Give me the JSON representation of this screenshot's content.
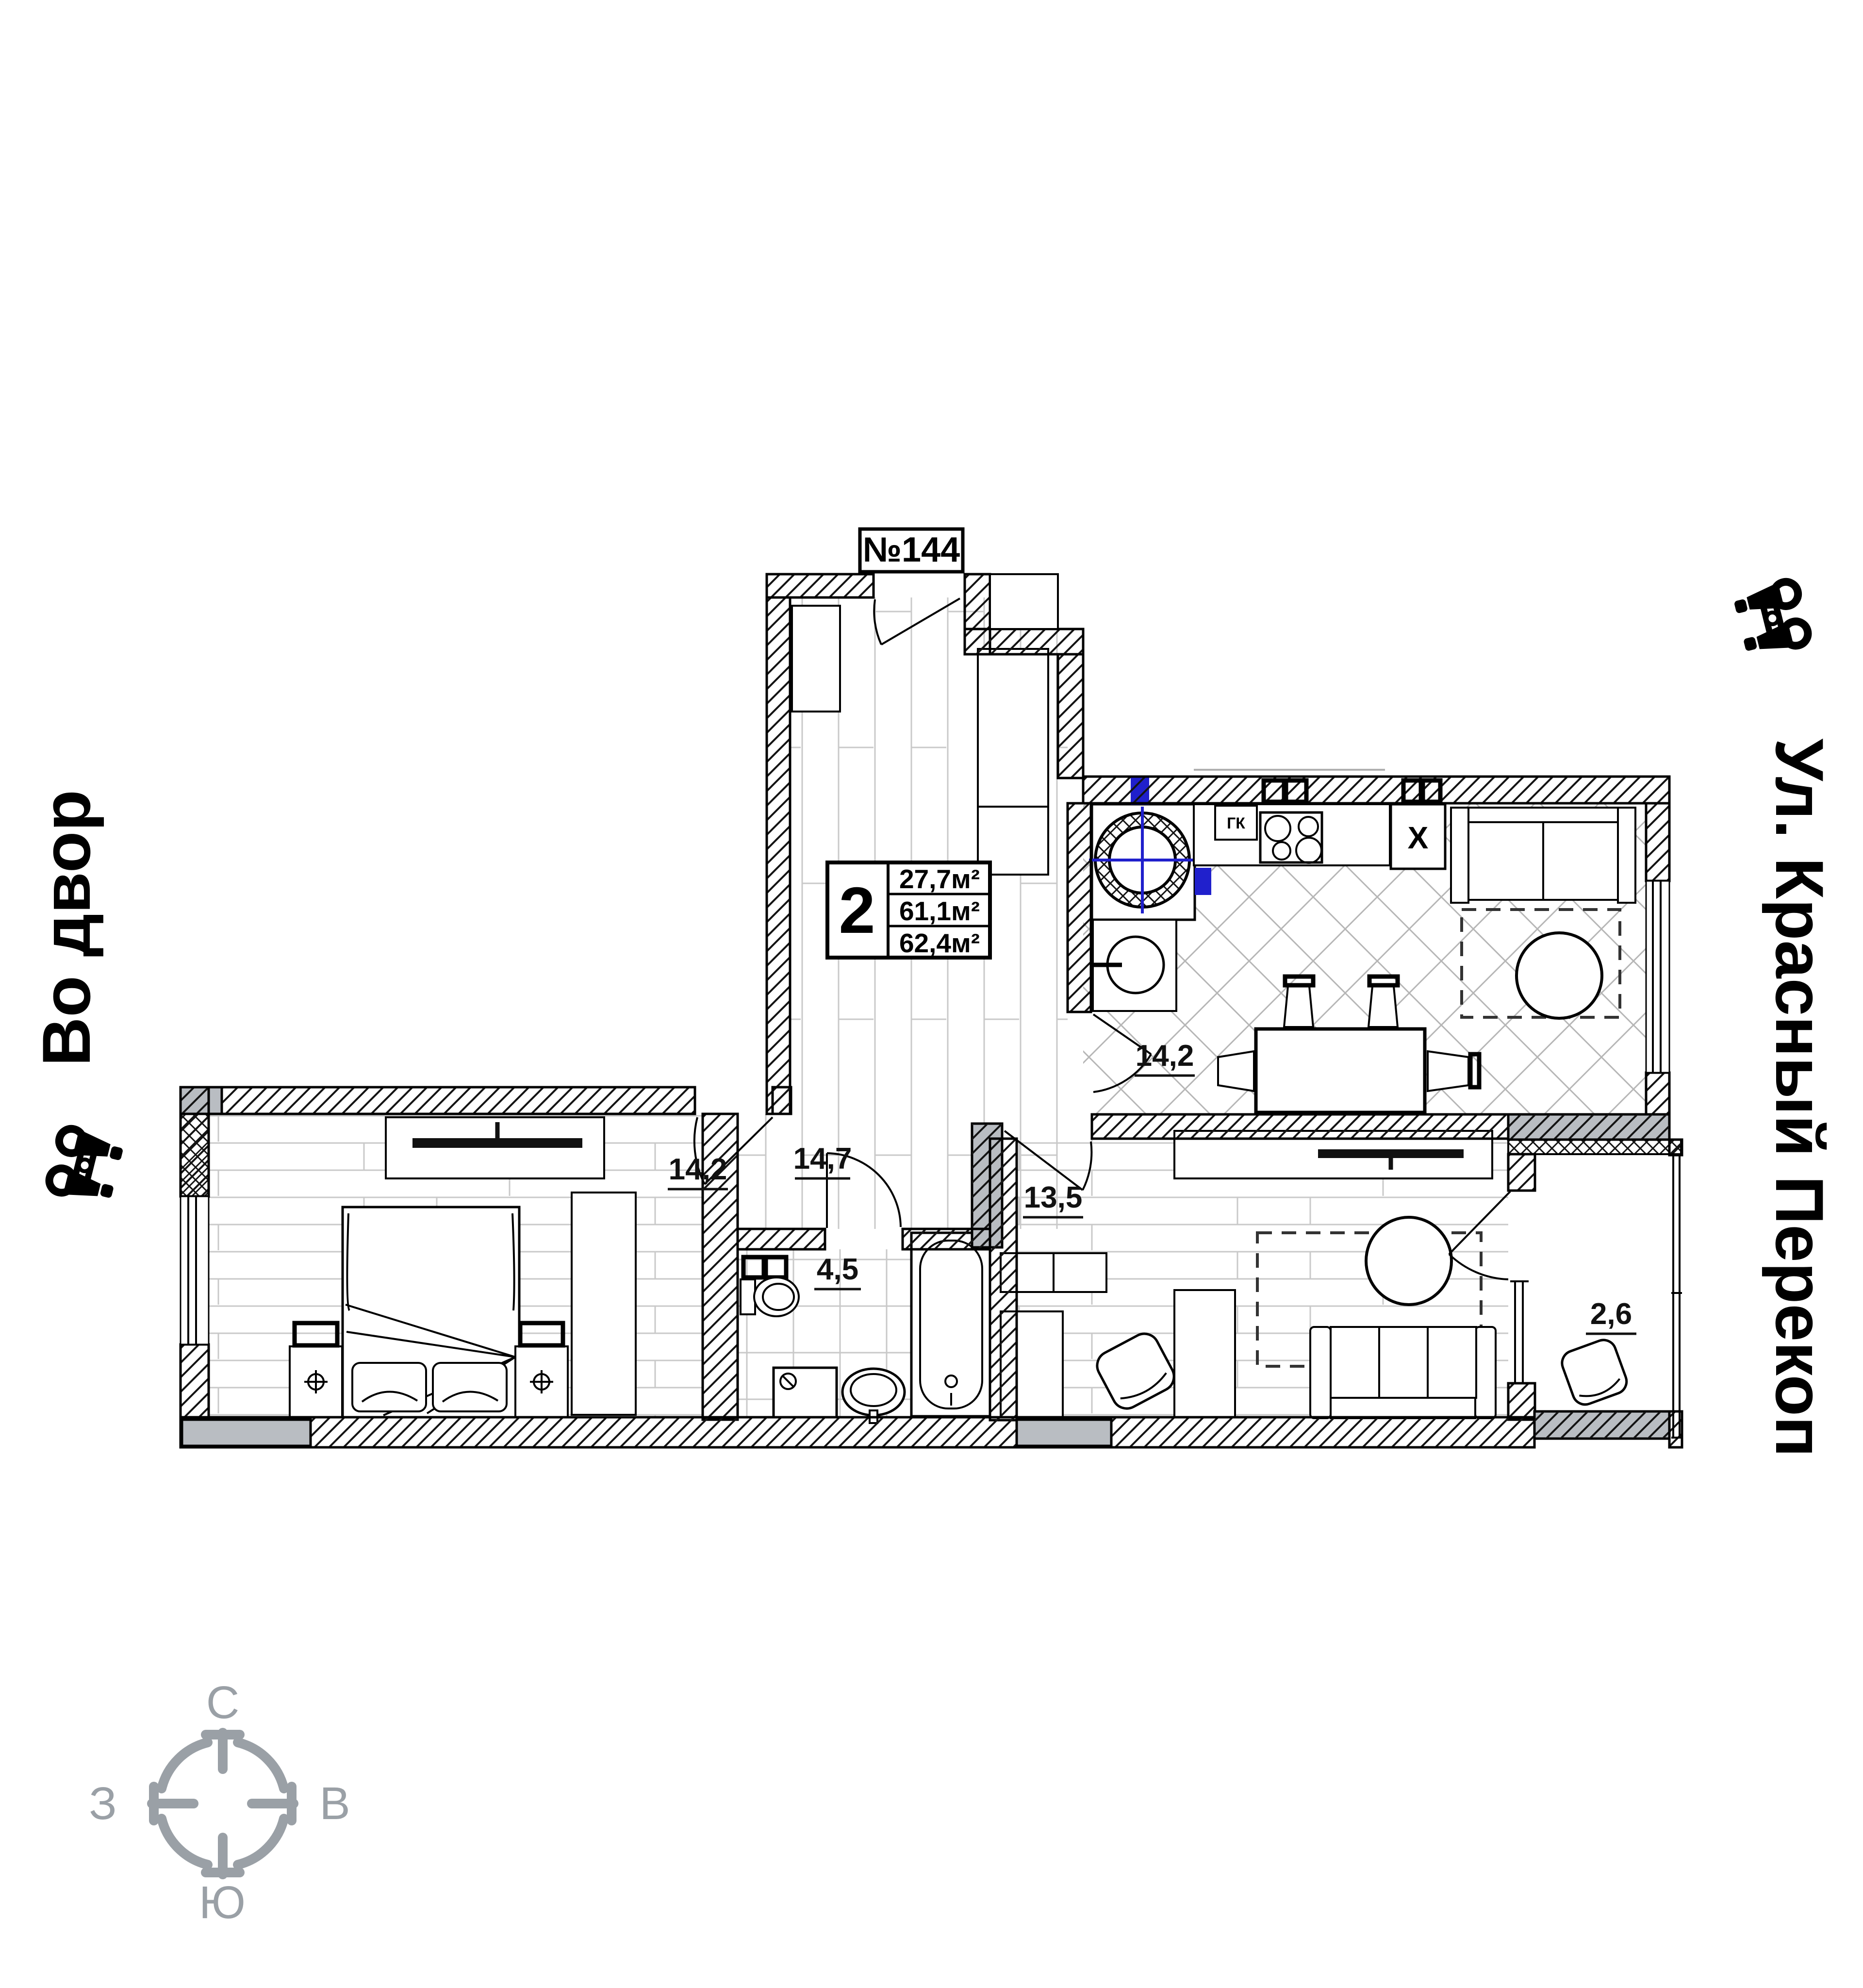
{
  "plan": {
    "apartment_number": "№144",
    "info_box": {
      "rooms": "2",
      "areas": [
        "27,7м²",
        "61,1м²",
        "62,4м²"
      ]
    },
    "room_labels": {
      "kitchen": "14,2",
      "hallway": "14,7",
      "bedroom": "14,2",
      "living_room": "13,5",
      "bathroom": "4,5",
      "balcony": "2,6"
    },
    "equipment_labels": {
      "gas_boiler": "ГК",
      "fridge": "X"
    }
  },
  "annotations": {
    "left_street": "Во двор",
    "right_street": "Ул. Красный Перекоп"
  },
  "compass": {
    "north": "С",
    "south": "Ю",
    "west": "З",
    "east": "В"
  },
  "colors": {
    "riser_blue": "#2020cc",
    "concrete_gray": "#b9bdc2",
    "compass_gray": "#9aa0a6"
  }
}
